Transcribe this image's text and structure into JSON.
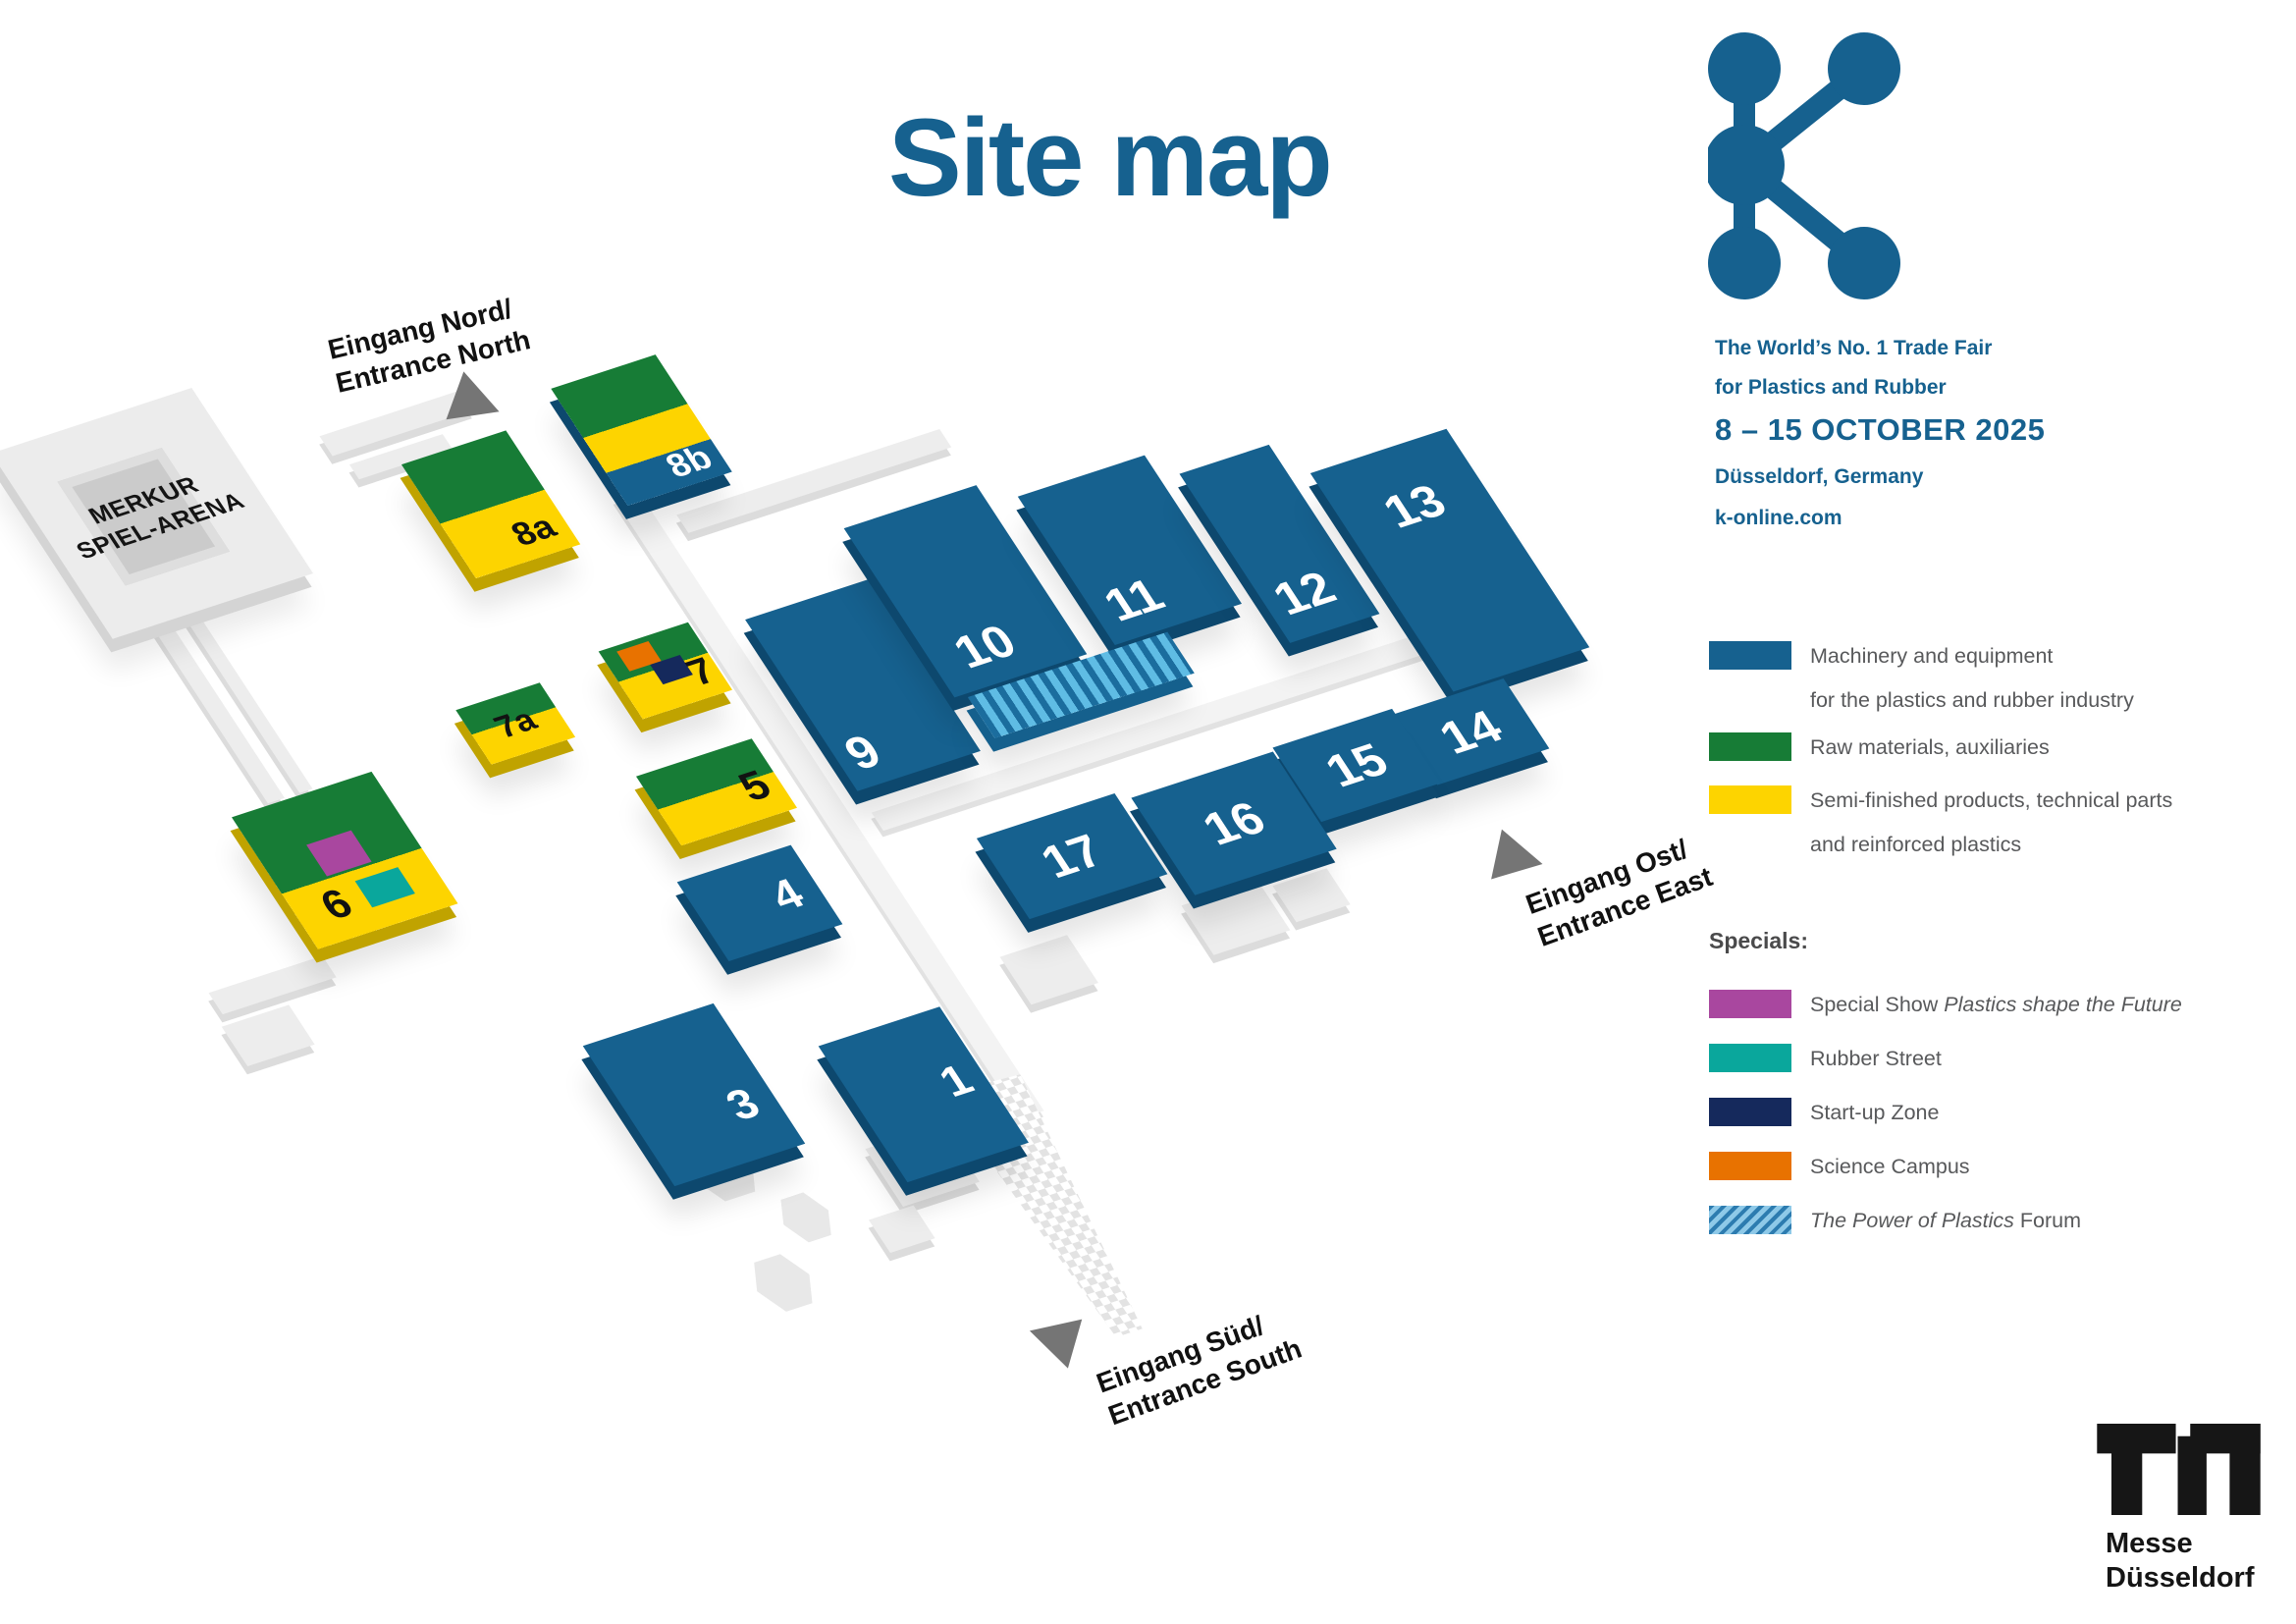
{
  "title": "Site map",
  "brand": {
    "tagline_line1": "The World’s No. 1 Trade Fair",
    "tagline_line2": "for Plastics and Rubber",
    "date_range": "8 – 15 OCTOBER 2025",
    "location": "Düsseldorf, Germany",
    "website": "k-online.com",
    "brand_blue": "#16618f"
  },
  "legend": {
    "categories": [
      {
        "line1": "Machinery and equipment",
        "line2": "for the plastics and rubber industry",
        "color": "#16618f"
      },
      {
        "line1": "Raw materials, auxiliaries",
        "line2": "",
        "color": "#177c36"
      },
      {
        "line1": "Semi-finished products, technical parts",
        "line2": "and reinforced plastics",
        "color": "#fdd400"
      }
    ],
    "specials_title": "Specials:",
    "specials": [
      {
        "prefix": "Special Show ",
        "italic": "Plastics shape the Future",
        "suffix": "",
        "color": "#a9479f"
      },
      {
        "prefix": "Rubber Street",
        "italic": "",
        "suffix": "",
        "color": "#0aa79c"
      },
      {
        "prefix": "Start-up Zone",
        "italic": "",
        "suffix": "",
        "color": "#15295c"
      },
      {
        "prefix": "Science Campus",
        "italic": "",
        "suffix": "",
        "color": "#e87200"
      },
      {
        "prefix": "",
        "italic": "The Power of Plastics",
        "suffix": " Forum",
        "color": "striped #5fbce4/#1b6d9e"
      }
    ]
  },
  "map": {
    "arena_line1": "MERKUR",
    "arena_line2": "SPIEL-ARENA",
    "hall_labels": {
      "h1": "1",
      "h3": "3",
      "h4": "4",
      "h5": "5",
      "h6": "6",
      "h7": "7",
      "h7a": "7a",
      "h8a": "8a",
      "h8b": "8b",
      "h9": "9",
      "h10": "10",
      "h11": "11",
      "h12": "12",
      "h13": "13",
      "h14": "14",
      "h15": "15",
      "h16": "16",
      "h17": "17"
    },
    "entrances": {
      "north_line1": "Eingang Nord/",
      "north_line2": "Entrance North",
      "east_line1": "Eingang Ost/",
      "east_line2": "Entrance East",
      "south_line1": "Eingang Süd/",
      "south_line2": "Entrance South"
    }
  },
  "footer": {
    "logo_line1": "Messe",
    "logo_line2": "Düsseldorf"
  }
}
